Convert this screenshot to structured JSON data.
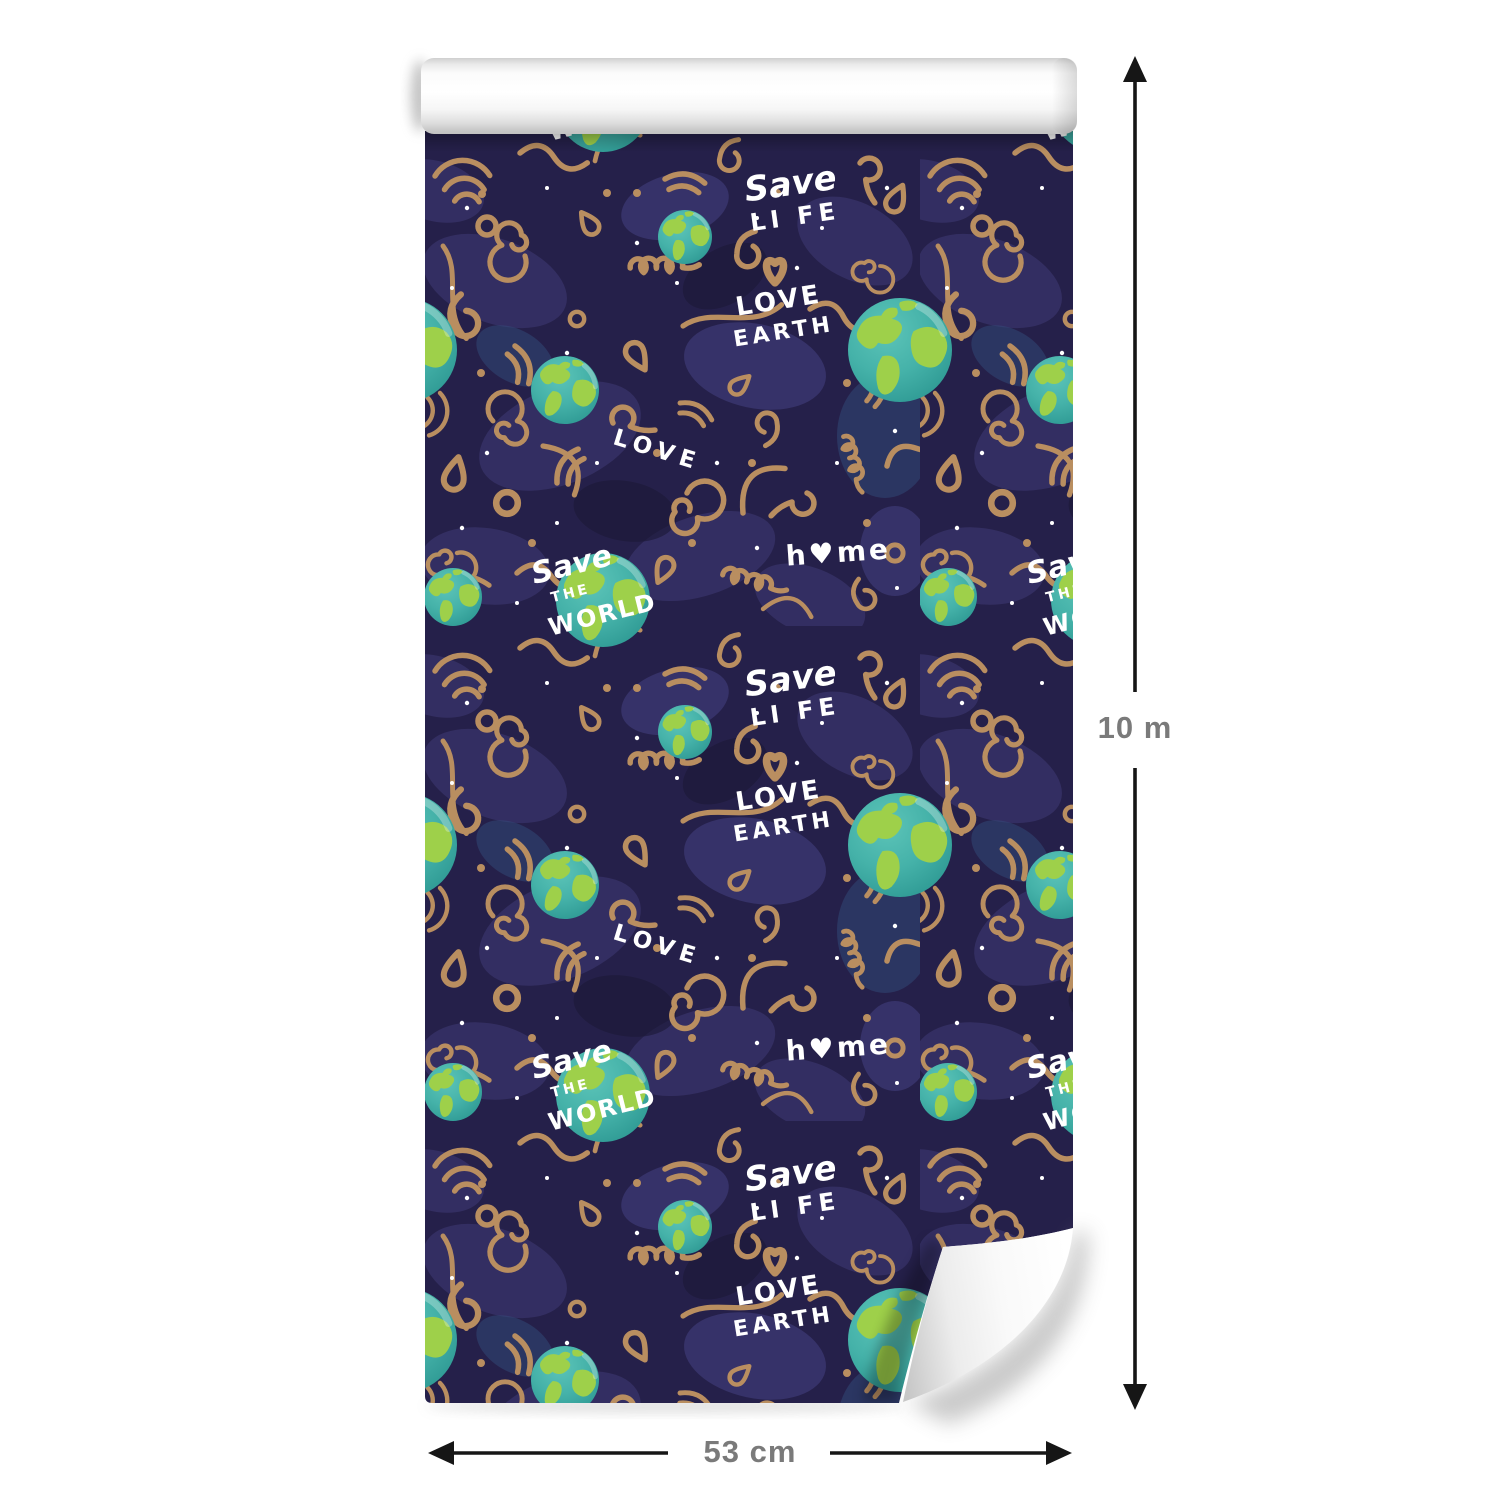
{
  "dimensions": {
    "height": "10 m",
    "width": "53 cm"
  },
  "pattern_texts": {
    "save": "Save",
    "life": "LI FE",
    "love": "LOVE",
    "earth": "EARTH",
    "love_script": "LOVE",
    "the": "THE",
    "world": "WORLD",
    "home": "h♥me"
  },
  "theme": {
    "bg": "#25204a",
    "doodle": "#b98e60",
    "doodle_light": "#c9a271",
    "blob": "#373268",
    "blob_light": "#413d7d",
    "blob_blue": "#33507e",
    "blob_dark": "#1b1735",
    "ocean": "#45b2a9",
    "ocean_light": "#5cc4b8",
    "ocean_deep": "#2f9a94",
    "land": "#9ed04a",
    "pattern_text": "#ffffff",
    "arrow": "#161616",
    "label": "#7a7a7a"
  }
}
